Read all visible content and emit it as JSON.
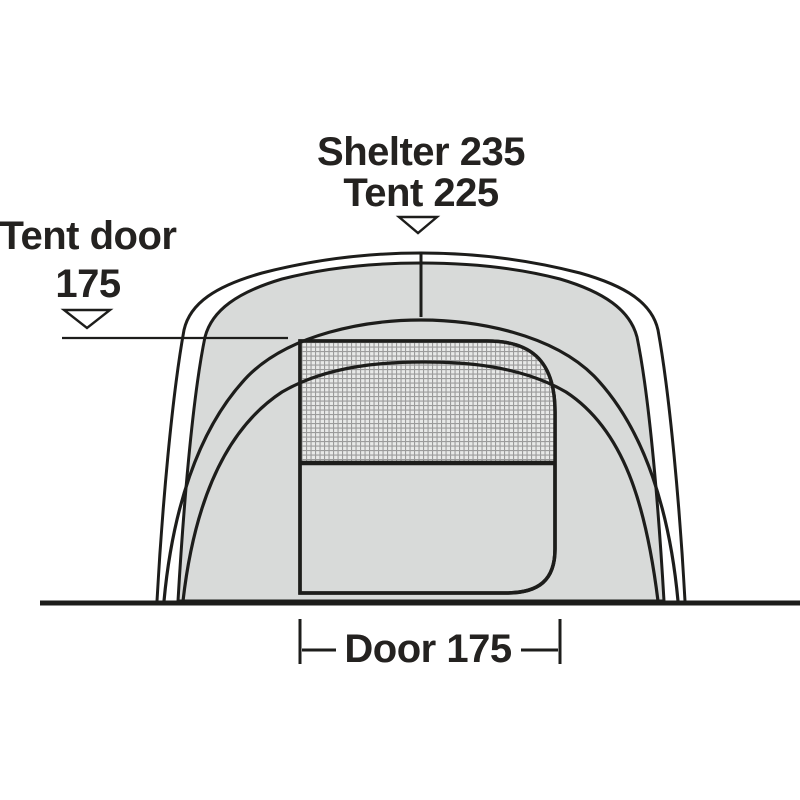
{
  "diagram": {
    "kind": "tent-front-view-dimension-diagram",
    "labels": {
      "top": {
        "line1": "Shelter 235",
        "line2": "Tent 225",
        "arrow": "down"
      },
      "left": {
        "line1": "Tent door",
        "line2": "175",
        "arrow": "down"
      },
      "bottom": {
        "label": "Door 175"
      }
    },
    "dimensions": {
      "shelter_width": 235,
      "tent_width": 225,
      "tent_door": 175,
      "door_width": 175
    },
    "colors": {
      "line": "#1d1d1b",
      "tent_fill": "#d8dad9",
      "mesh_background": "#e8e9e8",
      "mesh_line": "#9b9b9b",
      "text": "#242220",
      "background": "#ffffff"
    },
    "icons": {
      "top_marker": "down-arrow-icon",
      "left_marker": "down-arrow-icon"
    }
  }
}
